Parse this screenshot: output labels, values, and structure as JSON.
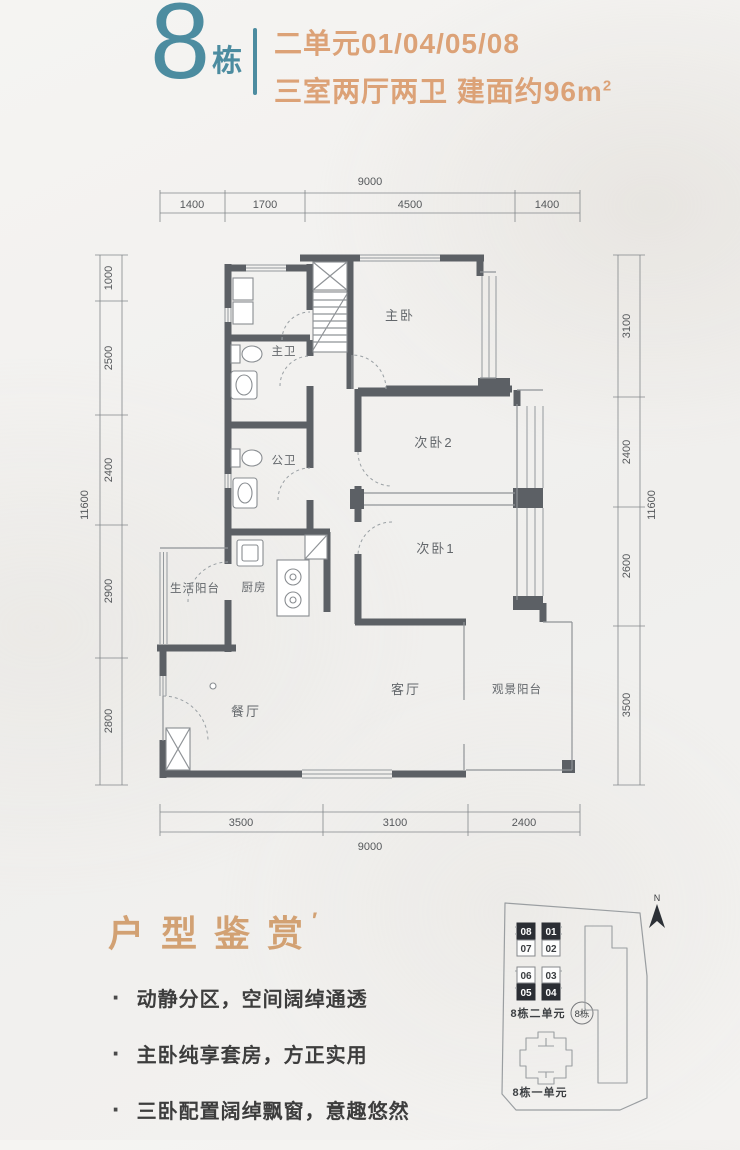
{
  "header": {
    "building_number": "8",
    "building_unit_suffix": "栋",
    "line1": "二单元01/04/05/08",
    "line2": "三室两厅两卫 建面约96m",
    "superscript": "2",
    "teal": "#4c8ca0",
    "orange": "#dca277"
  },
  "floor_plan": {
    "rooms": [
      {
        "name": "主卧"
      },
      {
        "name": "主卫"
      },
      {
        "name": "公卫"
      },
      {
        "name": "次卧2"
      },
      {
        "name": "次卧1"
      },
      {
        "name": "厨房"
      },
      {
        "name": "生活阳台"
      },
      {
        "name": "餐厅"
      },
      {
        "name": "客厅"
      },
      {
        "name": "观景阳台"
      }
    ],
    "dims": {
      "top_total": "9000",
      "top": [
        "1400",
        "1700",
        "4500",
        "1400"
      ],
      "bottom": [
        "3500",
        "3100",
        "2400"
      ],
      "bottom_total": "9000",
      "left": [
        "1000",
        "2500",
        "2400",
        "2900",
        "2800"
      ],
      "left_total": "11600",
      "right": [
        "3100",
        "2400",
        "2600",
        "3500"
      ],
      "right_total": "11600"
    }
  },
  "section": {
    "title": "户型鉴赏",
    "title_mark": "′",
    "bullet_char": "·",
    "bullets": [
      "动静分区，空间阔绰通透",
      "主卧纯享套房，方正实用",
      "三卧配置阔绰飘窗，意趣悠然"
    ]
  },
  "site_map": {
    "compass_label": "N",
    "units": [
      {
        "label": "08",
        "filled": true
      },
      {
        "label": "01",
        "filled": true
      },
      {
        "label": "07",
        "filled": false
      },
      {
        "label": "02",
        "filled": false
      },
      {
        "label": "06",
        "filled": false
      },
      {
        "label": "03",
        "filled": false
      },
      {
        "label": "05",
        "filled": true
      },
      {
        "label": "04",
        "filled": true
      }
    ],
    "unit2_label": "8栋二单元",
    "badge": "8栋",
    "unit1_label": "8栋一单元"
  }
}
